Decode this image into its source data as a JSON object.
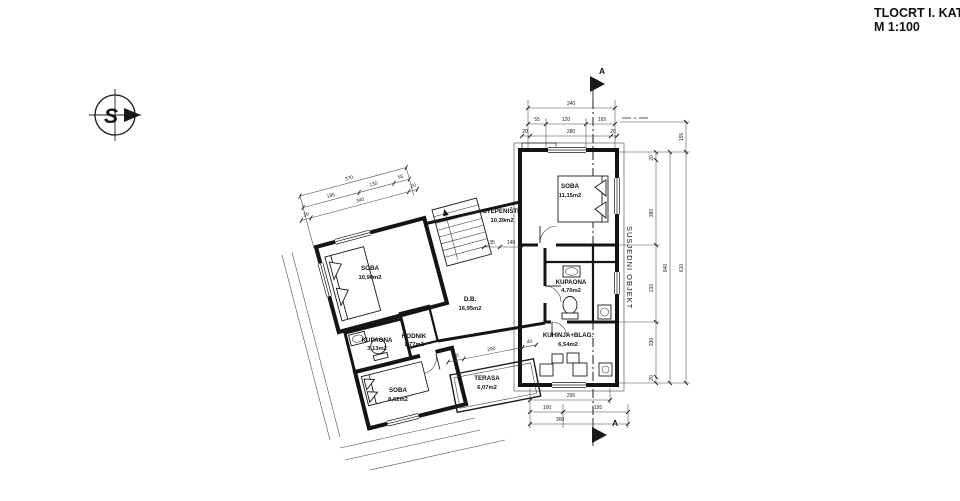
{
  "title": {
    "line1": "TLOCRT I. KATA",
    "line2": "M 1:100"
  },
  "north": {
    "letter": "S"
  },
  "section": {
    "label": "A"
  },
  "neighbor": {
    "label": "SUSJEDNI OBJEKT"
  },
  "rooms": [
    {
      "name": "SOBA",
      "area": "11,15m2"
    },
    {
      "name": "STEPENIŠTE",
      "area": "10,39m2"
    },
    {
      "name": "SOBA",
      "area": "10,90m2"
    },
    {
      "name": "D.B.",
      "area": "16,95m2"
    },
    {
      "name": "KUPAONA",
      "area": "4,70m2"
    },
    {
      "name": "KUHINJA+BLAG.",
      "area": "6,54m2"
    },
    {
      "name": "KUPAONA",
      "area": "3,13m2"
    },
    {
      "name": "HODNIK",
      "area": "1,77m2"
    },
    {
      "name": "SOBA",
      "area": "8,62m2"
    },
    {
      "name": "TERASA",
      "area": "6,07m2"
    }
  ],
  "dims": {
    "top": [
      "340",
      "55",
      "120",
      "165",
      "20",
      "280",
      "20"
    ],
    "right": [
      "155",
      "20",
      "380",
      "210",
      "230",
      "20",
      "840",
      "610"
    ],
    "bottom": [
      "295",
      "100",
      "195",
      "360"
    ],
    "left": [
      "370",
      "185",
      "130",
      "55",
      "20",
      "340",
      "20"
    ],
    "terrace": [
      "40",
      "290",
      "40"
    ],
    "stairs": [
      "35",
      "140"
    ]
  },
  "colors": {
    "ink": "#1a1a1a",
    "paper": "#ffffff"
  }
}
